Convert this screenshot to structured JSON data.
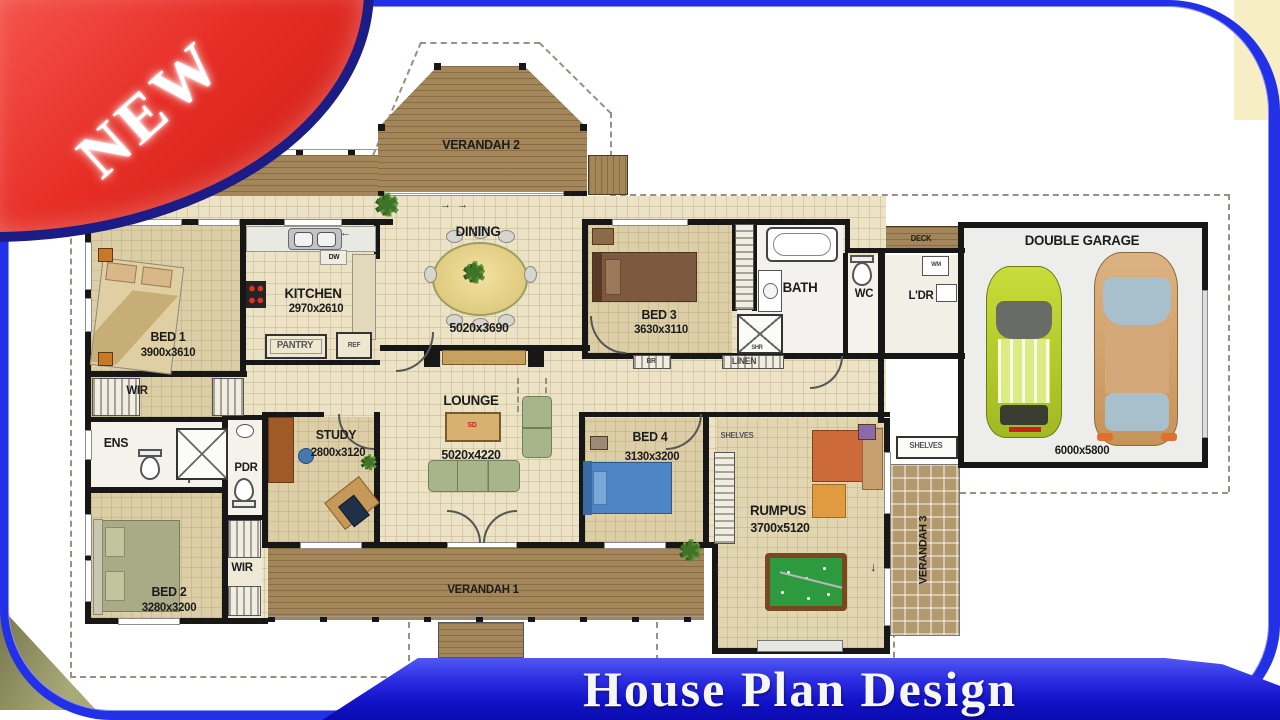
{
  "badge": {
    "label": "NEW"
  },
  "banner": {
    "title": "House Plan Design"
  },
  "colors": {
    "ribbon_red": "#e2261e",
    "frame_blue": "#2230e8",
    "banner_blue": "#1818d8",
    "deck_brown": "#a3875a",
    "wall_black": "#171717"
  },
  "plan": {
    "verandah2": {
      "name": "VERANDAH 2"
    },
    "verandah1": {
      "name": "VERANDAH 1"
    },
    "verandah3": {
      "name": "VERANDAH 3"
    },
    "bed1": {
      "name": "BED 1",
      "size": "3900x3610"
    },
    "bed2": {
      "name": "BED 2",
      "size": "3280x3200"
    },
    "bed3": {
      "name": "BED 3",
      "size": "3630x3110"
    },
    "bed4": {
      "name": "BED 4",
      "size": "3130x3200"
    },
    "kitchen": {
      "name": "KITCHEN",
      "size": "2970x2610"
    },
    "dining": {
      "name": "DINING",
      "size": "5020x3690"
    },
    "lounge": {
      "name": "LOUNGE",
      "size": "5020x4220"
    },
    "study": {
      "name": "STUDY",
      "size": "2800x3120"
    },
    "rumpus": {
      "name": "RUMPUS",
      "size": "3700x5120"
    },
    "garage": {
      "name": "DOUBLE GARAGE",
      "size": "6000x5800"
    },
    "bath": {
      "name": "BATH"
    },
    "ens": {
      "name": "ENS"
    },
    "wc": {
      "name": "WC"
    },
    "ldr": {
      "name": "L'DR"
    },
    "pdr": {
      "name": "PDR"
    },
    "wir1": {
      "name": "WIR"
    },
    "wir2": {
      "name": "WIR"
    },
    "pantry": {
      "name": "PANTRY"
    },
    "ref": {
      "name": "REF"
    },
    "dw": {
      "name": "DW"
    },
    "wm": {
      "name": "WM"
    },
    "linen": {
      "name": "LINEN"
    },
    "br": {
      "name": "BR"
    },
    "shr": {
      "name": "SHR"
    },
    "sd": {
      "name": "SD"
    },
    "deck": {
      "name": "DECK"
    },
    "shelves1": {
      "name": "SHELVES"
    },
    "shelves2": {
      "name": "SHELVES"
    }
  }
}
